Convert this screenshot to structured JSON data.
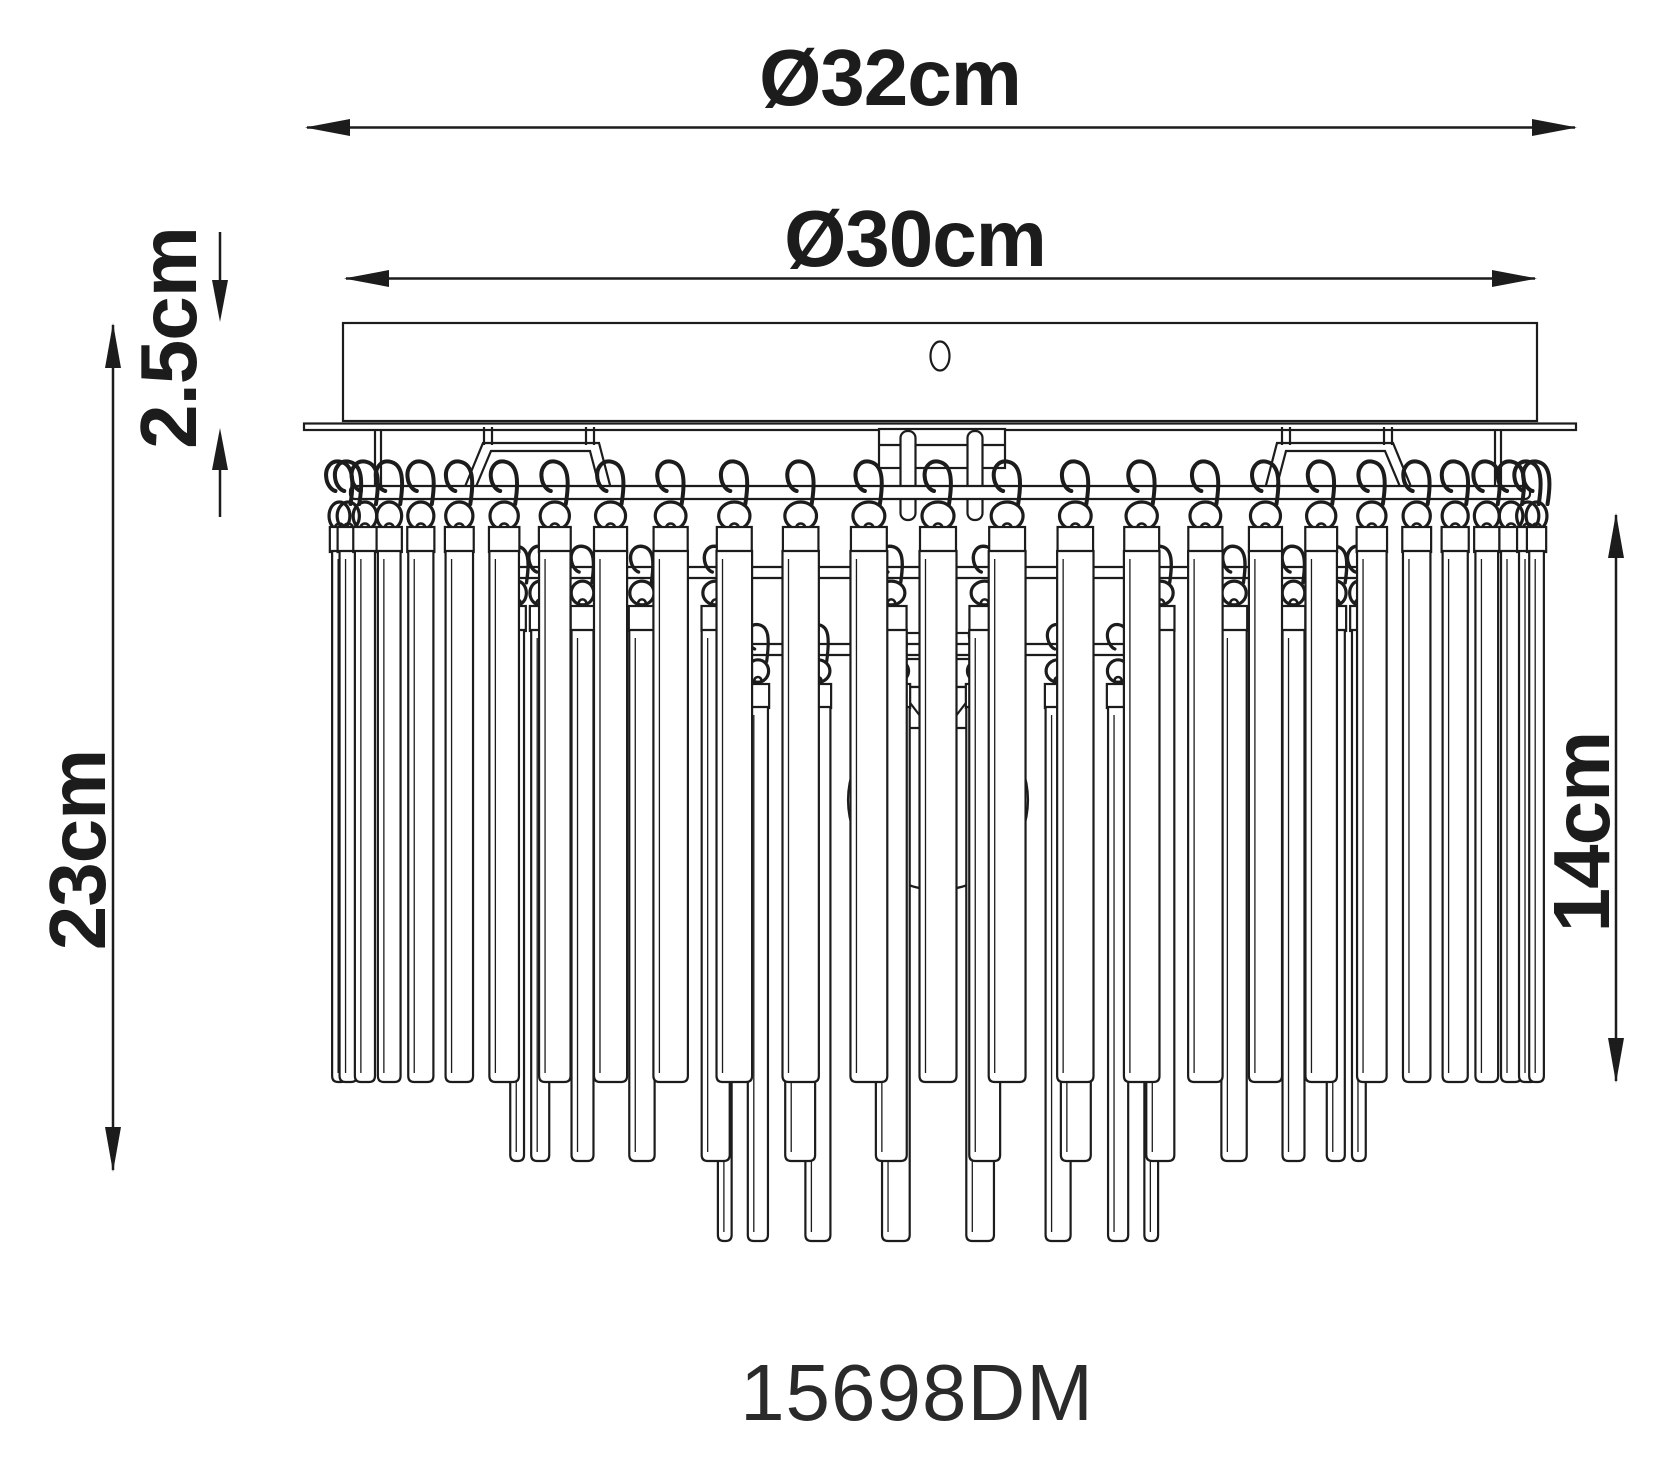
{
  "drawing": {
    "type_label": "ceiling-lamp-dimension-drawing",
    "product_code": "15698DM",
    "dims": {
      "outer": "Ø32cm",
      "plate": "Ø30cm",
      "canopy": "2.5cm",
      "height": "23cm",
      "crystal": "14cm"
    },
    "colors": {
      "line": "#1c1c1c",
      "background": "#ffffff"
    }
  }
}
